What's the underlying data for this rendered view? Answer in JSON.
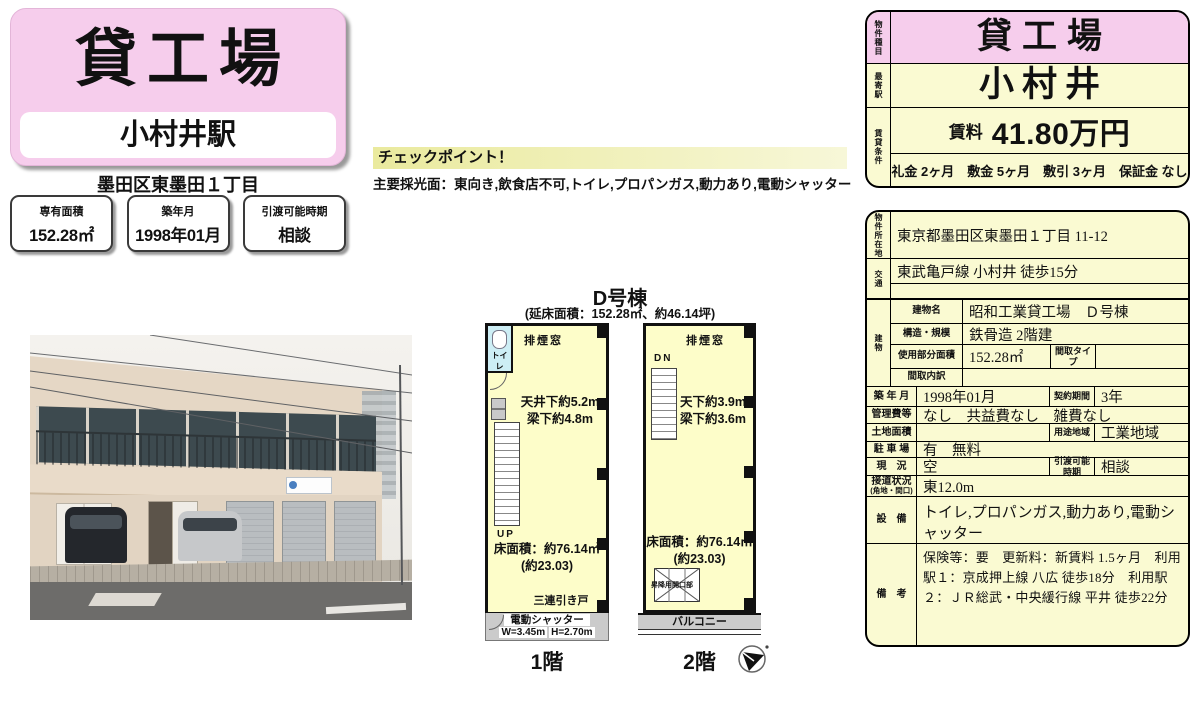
{
  "colors": {
    "pink": "#f6cdec",
    "cream_yellow": "#fafad2",
    "plan_yellow": "#fdfdc9",
    "checkpoint_yellow": "#eaea9e",
    "toilet_blue": "#cdeef5"
  },
  "left": {
    "title": "貸工場",
    "station": "小村井駅",
    "address": "墨田区東墨田１丁目",
    "stats": [
      {
        "label": "専有面積",
        "value": "152.28㎡"
      },
      {
        "label": "築年月",
        "value": "1998年01月"
      },
      {
        "label": "引渡可能時期",
        "value": "相談"
      }
    ]
  },
  "checkpoint": {
    "title": "チェックポイント！",
    "body": "主要採光面：東向き,飲食店不可,トイレ,プロパンガス,動力あり,電動シャッター"
  },
  "floorplan": {
    "building_title": "D号棟",
    "subtitle": "(延床面積：152.28㎡、約46.14坪)",
    "floor1": {
      "smoke_window": "排煙窓",
      "toilet": "トイレ",
      "ceiling": "天井下約5.2m",
      "beam": "梁下約4.8m",
      "up": "UP",
      "floor_area": "床面積：約76.14㎡",
      "floor_area_tsubo": "(約23.03)",
      "sliding_door": "三連引き戸",
      "shutter": "電動シャッター",
      "shutter_w": "W=3.45m",
      "shutter_h": "H=2.70m",
      "caption": "1階"
    },
    "floor2": {
      "smoke_window": "排煙窓",
      "down": "DN",
      "ceiling": "天下約3.9m",
      "beam": "梁下約3.6m",
      "floor_area": "床面積：約76.14㎡",
      "floor_area_tsubo": "(約23.03)",
      "hoist_opening": "昇降用開口部",
      "balcony": "バルコニー",
      "caption": "2階"
    }
  },
  "table": {
    "type_label": "物件種目",
    "type_value": "貸工場",
    "station_label": "最寄駅",
    "station_value": "小村井",
    "terms_label": "賃貸条件",
    "rent_label": "賃料",
    "rent_value": "41.80万円",
    "terms_value": "礼金 2ヶ月　敷金 5ヶ月　敷引 3ヶ月　保証金 なし",
    "location_label": "物件所在地",
    "location_value": "東京都墨田区東墨田１丁目 11-12",
    "access_label": "交通",
    "access_line1": "東武亀戸線 小村井 徒歩15分",
    "access_line2": "",
    "building_label": "建物",
    "building_name_label": "建物名",
    "building_name": "昭和工業貸工場　Ｄ号棟",
    "structure_label": "構造・規模",
    "structure": "鉄骨造 2階建",
    "used_area_label": "使用部分面積",
    "used_area": "152.28㎡",
    "madori_type_label": "間取タイプ",
    "madori_type": "",
    "madori_breakdown_label": "間取内訳",
    "madori_breakdown": "",
    "built_label": "築 年 月",
    "built": "1998年01月",
    "contract_label": "契約期間",
    "contract": "3年",
    "kanrihi_label": "管理費等",
    "kanrihi": "なし　共益費なし　雑費なし",
    "land_label": "土地面積",
    "land": "",
    "zoning_label": "用途地域",
    "zoning": "工業地域",
    "parking_label": "駐 車 場",
    "parking": "有　無料",
    "status_label": "現　況",
    "status": "空",
    "handover_label": "引渡可能時期",
    "handover": "相談",
    "road_label": "接道状況",
    "road_label2": "(角地・間口)",
    "road": "東12.0m",
    "equipment_label": "設　備",
    "equipment": "トイレ,プロパンガス,動力あり,電動シャッター",
    "remarks_label": "備　考",
    "remarks": "保険等：要　更新料：新賃料 1.5ヶ月　利用駅１：京成押上線 八広 徒歩18分　利用駅２：ＪＲ総武・中央緩行線 平井 徒歩22分"
  }
}
